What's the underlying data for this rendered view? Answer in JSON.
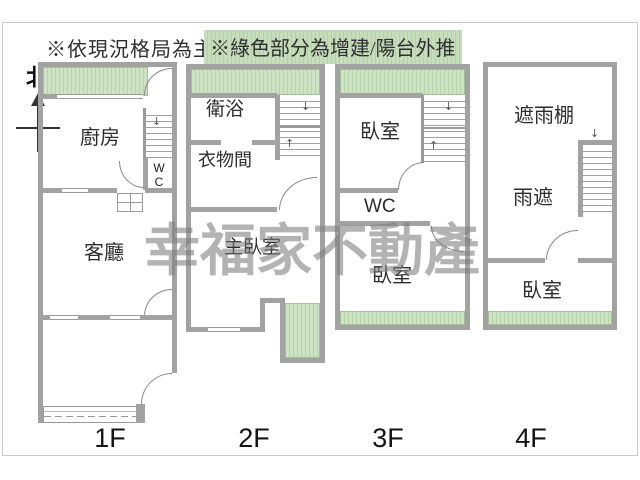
{
  "notes": {
    "primary": "※依現況格局為主",
    "green": "※綠色部分為增建/陽台外推"
  },
  "compass": {
    "north": "北"
  },
  "watermark": {
    "text": "幸福家不動產"
  },
  "icons": {
    "arrow_down": "↓",
    "arrow_up": "↑"
  },
  "floors": {
    "f1": {
      "label": "1F",
      "kitchen": "廚房",
      "wc": "W C",
      "living": "客廳"
    },
    "f2": {
      "label": "2F",
      "bathroom": "衛浴",
      "closet": "衣物間",
      "master_bedroom": "主臥室"
    },
    "f3": {
      "label": "3F",
      "bedroom_top": "臥室",
      "wc": "WC",
      "bedroom_bottom": "臥室"
    },
    "f4": {
      "label": "4F",
      "canopy": "遮雨棚",
      "rain_shade": "雨遮",
      "bedroom": "臥室"
    }
  },
  "legend_colors": {
    "green_area": "#bcd6ae",
    "wall": "#a2a2a2"
  }
}
